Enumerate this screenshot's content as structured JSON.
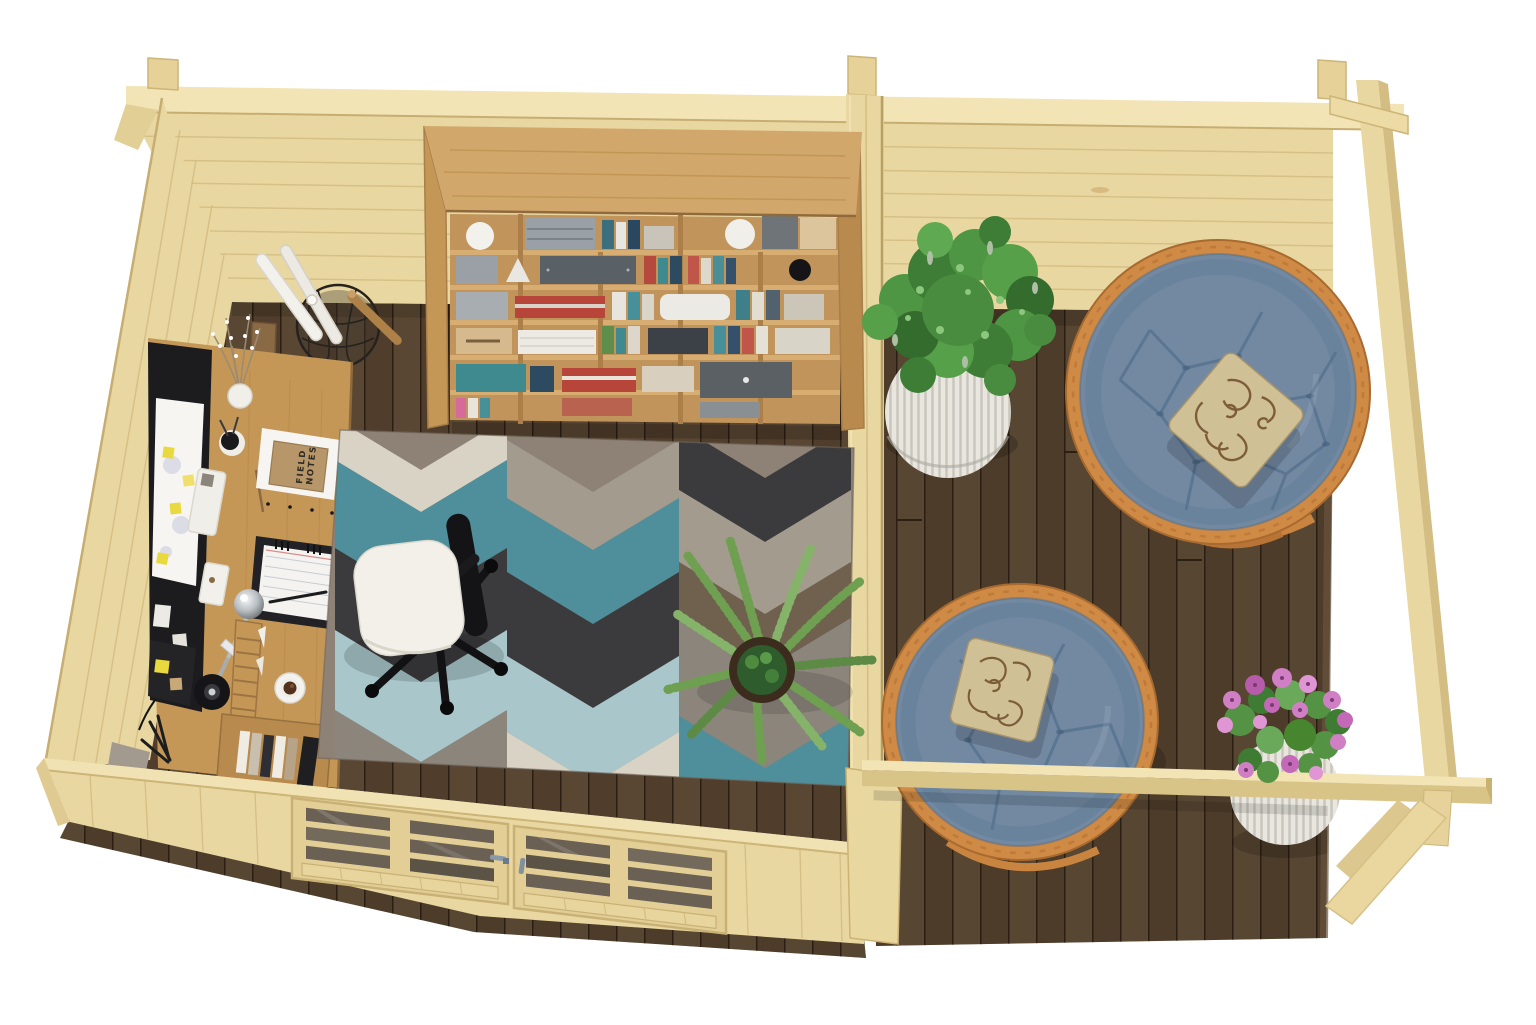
{
  "scene": {
    "description": "Top-down 3D render of a pine garden office cabin with a home office room (desk, bookshelf, geometric rug) and an open terrace with two papasan chairs and planters",
    "labels": {
      "field_notes_line1": "FIELD",
      "field_notes_line2": "NOTES"
    },
    "inventory": [
      "pine log-cabin walls",
      "glazed double front doors",
      "oak office desk with accessories",
      "black desk organizer panel with calendar and sticky notes",
      "white office chair",
      "oak bookshelf with books and boxes",
      "wire basket with paper rolls",
      "geometric chevron area rug",
      "potted palm plant",
      "dark walnut terrace decking",
      "two papasan chairs with blue tufted cushions",
      "swirl-pattern throw pillows",
      "white ribbed planter with green shrub",
      "white ribbed planter with pink flowers",
      "pergola posts, front rail and corner braces",
      "coffee cup on saucer",
      "chrome desk lamp"
    ],
    "colors": {
      "background": "#ffffff",
      "pine": "#e9d7a1",
      "pine_light": "#f2e4b4",
      "pine_shadow": "#d9c488",
      "pine_edge": "#c6ad72",
      "oak": "#c59757",
      "oak_light": "#d2a76b",
      "oak_dark": "#a87f49",
      "floor": "#56422f",
      "deck": "#52402e",
      "rug_base": "#8d8275",
      "rug_cream": "#d9d3c5",
      "rug_gray": "#a39b8d",
      "rug_gray2": "#8b857b",
      "rug_teal": "#4f8f9b",
      "rug_lightblue": "#a9c6cb",
      "rug_charcoal": "#3b3a3c",
      "rug_brown": "#70604e",
      "cushion_blue": "#7289a1",
      "rattan": "#cf8a45",
      "pillow_beige": "#cfc096",
      "pillow_brown": "#7d5c3a",
      "seat_white": "#f2f0e9",
      "chair_black": "#141416",
      "panel_black": "#1c1c1f",
      "paper_white": "#f6f5f1",
      "sticky_yellow": "#ead83f",
      "kraft": "#b7976a",
      "glass": "#6a6054",
      "handle_gray": "#8b9aa8",
      "plant_green": "#4f9644",
      "palm_green": "#6f9f50",
      "flower_pink": "#d07fc4",
      "planter_white": "#e9e6e0",
      "coffee": "#53311d"
    }
  }
}
